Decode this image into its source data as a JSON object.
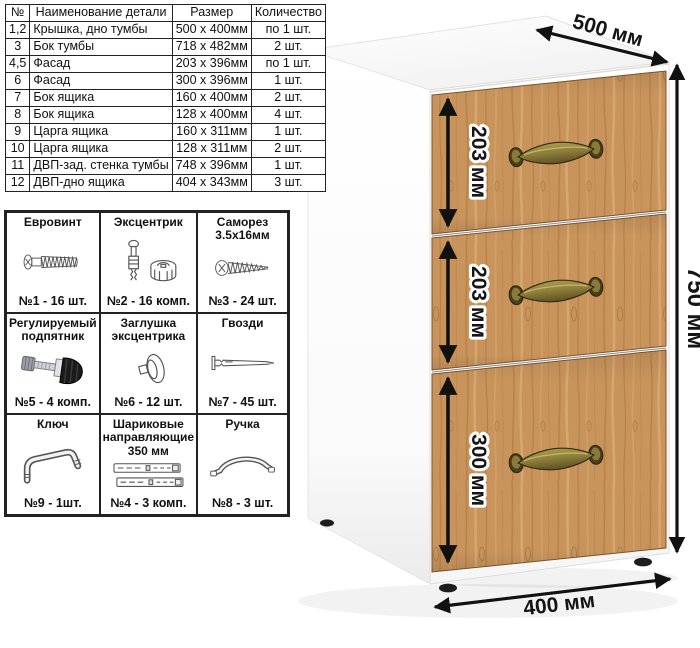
{
  "parts_table": {
    "headers": [
      "№",
      "Наименование детали",
      "Размер",
      "Количество"
    ],
    "rows": [
      [
        "1,2",
        "Крышка, дно тумбы",
        "500 х 400мм",
        "по 1 шт."
      ],
      [
        "3",
        "Бок тумбы",
        "718 х 482мм",
        "2 шт."
      ],
      [
        "4,5",
        "Фасад",
        "203 х 396мм",
        "по 1 шт."
      ],
      [
        "6",
        "Фасад",
        "300 х 396мм",
        "1 шт."
      ],
      [
        "7",
        "Бок ящика",
        "160 х 400мм",
        "2 шт."
      ],
      [
        "8",
        "Бок ящика",
        "128 х 400мм",
        "4 шт."
      ],
      [
        "9",
        "Царга ящика",
        "160 х 311мм",
        "1 шт."
      ],
      [
        "10",
        "Царга ящика",
        "128 х 311мм",
        "2 шт."
      ],
      [
        "11",
        "ДВП-зад. стенка тумбы",
        "748 х 396мм",
        "1 шт."
      ],
      [
        "12",
        "ДВП-дно ящика",
        "404 х 343мм",
        "3 шт."
      ]
    ]
  },
  "hardware": [
    {
      "title": "Евровинт",
      "count": "№1 - 16 шт.",
      "icon": "euro-screw"
    },
    {
      "title": "Эксцентрик",
      "count": "№2 - 16 комп.",
      "icon": "eccentric-cam"
    },
    {
      "title": "Саморез 3.5х16мм",
      "count": "№3 - 24 шт.",
      "icon": "self-tapping-screw"
    },
    {
      "title": "Регулируемый подпятник",
      "count": "№5 - 4 комп.",
      "icon": "adjustable-foot"
    },
    {
      "title": "Заглушка эксцентрика",
      "count": "№6 - 12 шт.",
      "icon": "cam-cover"
    },
    {
      "title": "Гвозди",
      "count": "№7 - 45 шт.",
      "icon": "nail"
    },
    {
      "title": "Ключ",
      "count": "№9 - 1шт.",
      "icon": "hex-key"
    },
    {
      "title": "Шариковые направляющие 350 мм",
      "count": "№4 - 3 комп.",
      "icon": "ball-bearing-slides"
    },
    {
      "title": "Ручка",
      "count": "№8 - 3 шт.",
      "icon": "bow-handle"
    }
  ],
  "dimensions": {
    "depth": "500 мм",
    "height": "750 мм",
    "width": "400 мм",
    "drawers": [
      "203 мм",
      "203 мм",
      "300 мм"
    ]
  },
  "colors": {
    "wood_base": "#c8945c",
    "handle_brass": "#8a7b39",
    "arrow_black": "#111111",
    "border_black": "#222222"
  }
}
